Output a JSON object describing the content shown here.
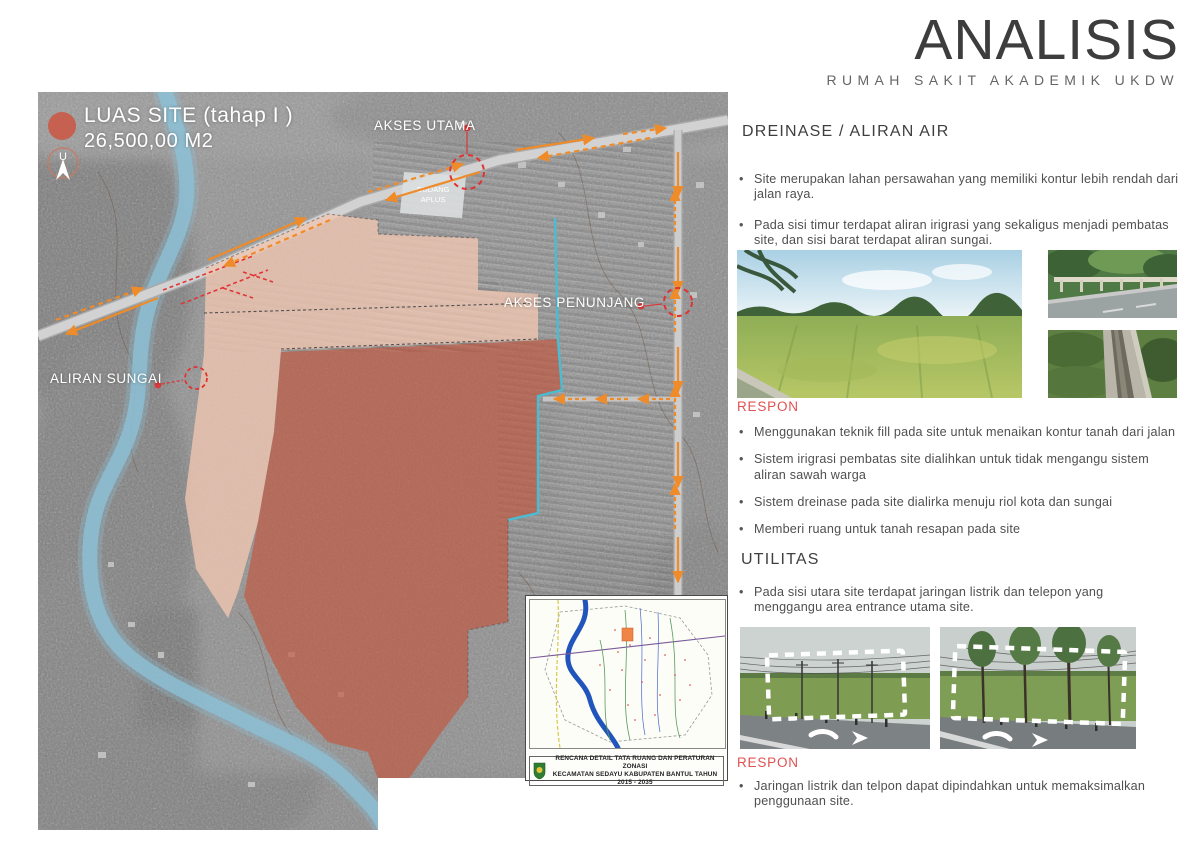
{
  "header": {
    "title": "ANALISIS",
    "subtitle": "RUMAH SAKIT AKADEMIK UKDW"
  },
  "map": {
    "legend": {
      "title": "LUAS SITE (tahap I )",
      "area": "26,500,00 M2",
      "north_label": "U"
    },
    "labels": {
      "akses_utama": "AKSES UTAMA",
      "akses_penunjang": "AKSES PENUNJANG",
      "aliran_sungai": "ALIRAN SUNGAI",
      "gudang_line1": "GUDANG",
      "gudang_line2": "APLUS"
    },
    "inset": {
      "caption_line1": "RENCANA DETAIL TATA RUANG DAN PERATURAN ZONASI",
      "caption_line2": "KECAMATAN SEDAYU KABUPATEN BANTUL TAHUN 2015 - 2035"
    }
  },
  "sections": {
    "dreinase": {
      "title": "DREINASE / ALIRAN AIR",
      "bullets": [
        "Site merupakan lahan persawahan yang memiliki kontur lebih rendah dari jalan raya.",
        "Pada sisi timur terdapat aliran irigrasi yang sekaligus menjadi pembatas site, dan sisi barat terdapat aliran sungai."
      ]
    },
    "respon1": {
      "title": "RESPON",
      "bullets": [
        "Menggunakan teknik fill pada site untuk menaikan kontur tanah dari jalan",
        "Sistem irigrasi pembatas site dialihkan untuk tidak mengangu sistem aliran sawah warga",
        "Sistem dreinase pada site dialirka menuju riol kota dan sungai",
        "Memberi ruang untuk tanah resapan pada site"
      ]
    },
    "utilitas": {
      "title": "UTILITAS",
      "bullets": [
        "Pada sisi utara site terdapat jaringan listrik dan telepon yang menggangu area entrance utama site."
      ]
    },
    "respon2": {
      "title": "RESPON",
      "bullets": [
        "Jaringan listrik dan telpon dapat dipindahkan untuk memaksimalkan penggunaan site."
      ]
    }
  },
  "colors": {
    "accent_red": "#e05252",
    "label_red": "#e03232",
    "site_fill": "#c2563e",
    "site_fill_light": "#efc5b2",
    "river_blue": "#8cc0d4",
    "arrow_orange": "#ef8b28",
    "irrigation_cyan": "#49bdd3",
    "legend_dot": "#c95a49"
  }
}
